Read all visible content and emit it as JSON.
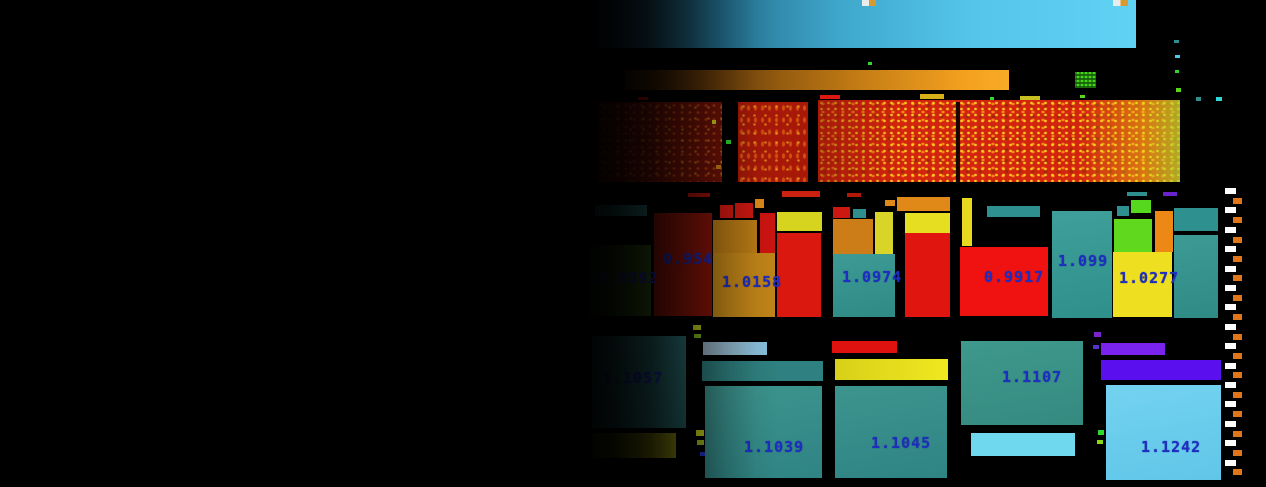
{
  "meta": {
    "width": 1266,
    "height": 487,
    "background": "#000000"
  },
  "colors": {
    "label_blue": "#1f2ec2",
    "legend_white": "#ffffff",
    "legend_orange": "#e0761a",
    "panel_blue_bright": "#60d2f4",
    "bar_orange_bright": "#f7ab26"
  },
  "chart_data": {
    "type": "heatmap",
    "title": "",
    "grid": false,
    "legend_position": "right",
    "series": [
      {
        "name": "middle-row-tiles",
        "points": [
          {
            "label": "0.9592",
            "value": 0.9592,
            "tile_color": "#3a6012"
          },
          {
            "label": "0.954",
            "value": 0.954,
            "tile_color": "#8c1408"
          },
          {
            "label": "1.0158",
            "value": 1.0158,
            "tile_color": "#c08418"
          },
          {
            "label": "1.0974",
            "value": 1.0974,
            "tile_color": "#2f9090"
          },
          {
            "label": "0.9917",
            "value": 0.9917,
            "tile_color": "#f01210"
          },
          {
            "label": "1.099",
            "value": 1.099,
            "tile_color": "#2f9595"
          },
          {
            "label": "1.0277",
            "value": 1.0277,
            "tile_color": "#eee020"
          }
        ]
      },
      {
        "name": "bottom-row-tiles",
        "points": [
          {
            "label": "1.1057",
            "value": 1.1057,
            "tile_color": "#2a6f70"
          },
          {
            "label": "1.1039",
            "value": 1.1039,
            "tile_color": "#2f8888"
          },
          {
            "label": "1.1045",
            "value": 1.1045,
            "tile_color": "#2f8888"
          },
          {
            "label": "1.1107",
            "value": 1.1107,
            "tile_color": "#35968c"
          },
          {
            "label": "1.1242",
            "value": 1.1242,
            "tile_color": "#66cbee"
          }
        ]
      }
    ]
  },
  "scene": {
    "blocks": [
      {
        "name": "top-blue-panel",
        "x": 598,
        "y": 0,
        "w": 538,
        "h": 48,
        "bg": "linear-gradient(90deg,#123140 0%,#24708f 22%,#3fa7cc 45%,#55c6ea 70%,#60d2f4 100%)"
      },
      {
        "name": "top-marker-icon-1",
        "x": 862,
        "y": 0,
        "w": 14,
        "h": 6,
        "inter": false,
        "bg": "linear-gradient(90deg,#e8ecec 0 50%,#d89a30 50% 100%)"
      },
      {
        "name": "top-marker-icon-2",
        "x": 1113,
        "y": 0,
        "w": 15,
        "h": 6,
        "inter": false,
        "bg": "linear-gradient(90deg,#e8ecec 0 50%,#d89a30 50% 100%)"
      },
      {
        "name": "orange-gradient-bar",
        "x": 625,
        "y": 70,
        "w": 384,
        "h": 20,
        "bg": "linear-gradient(90deg,#2e1603,#7c4a0c 30%,#c27b14 60%,#f3a01f 88%,#f7ab26)"
      },
      {
        "name": "green-texture-chip",
        "x": 1075,
        "y": 72,
        "w": 21,
        "h": 16,
        "cls": "chip"
      },
      {
        "name": "band-module-left",
        "x": 598,
        "y": 102,
        "w": 124,
        "h": 80,
        "cls": "speckle-dim"
      },
      {
        "name": "band-module-mid",
        "x": 738,
        "y": 102,
        "w": 70,
        "h": 80,
        "cls": "speckle-mid"
      },
      {
        "name": "band-module-right",
        "x": 818,
        "y": 100,
        "w": 362,
        "h": 82,
        "cls": "speckle-hot"
      },
      {
        "name": "band-divider",
        "x": 956,
        "y": 102,
        "w": 4,
        "h": 80,
        "inter": false,
        "bg": "#1a0500"
      },
      {
        "name": "mid-teal-strip",
        "x": 595,
        "y": 205,
        "w": 52,
        "h": 11,
        "bg": "#2f8585"
      },
      {
        "name": "mid-cell-0-9592",
        "x": 590,
        "y": 245,
        "w": 61,
        "h": 71,
        "bg": "linear-gradient(90deg,#1e3c12,#3a6012)",
        "label": "0.9592",
        "lx": 598,
        "ly": 269
      },
      {
        "name": "mid-cell-0-954",
        "x": 654,
        "y": 213,
        "w": 58,
        "h": 103,
        "bg": "#8c1408",
        "label": "0.954",
        "lx": 663,
        "ly": 250
      },
      {
        "name": "mid-red-chip-1",
        "x": 720,
        "y": 205,
        "w": 13,
        "h": 13,
        "bg": "#cc1810"
      },
      {
        "name": "mid-red-chip-2",
        "x": 735,
        "y": 203,
        "w": 18,
        "h": 15,
        "bg": "#cc1810"
      },
      {
        "name": "mid-tan-top",
        "x": 713,
        "y": 220,
        "w": 44,
        "h": 33,
        "bg": "#b87a16"
      },
      {
        "name": "mid-red-narrow",
        "x": 760,
        "y": 213,
        "w": 15,
        "h": 40,
        "bg": "#cc1410"
      },
      {
        "name": "mid-cell-1-0158",
        "x": 713,
        "y": 253,
        "w": 62,
        "h": 64,
        "bg": "#c08418",
        "label": "1.0158",
        "lx": 722,
        "ly": 273
      },
      {
        "name": "mid-yellow-top",
        "x": 777,
        "y": 212,
        "w": 45,
        "h": 19,
        "bg": "#d6d41e"
      },
      {
        "name": "mid-red-tall-1",
        "x": 777,
        "y": 233,
        "w": 44,
        "h": 84,
        "bg": "#da1810"
      },
      {
        "name": "mid-red-chip-3",
        "x": 833,
        "y": 207,
        "w": 17,
        "h": 11,
        "bg": "#cc1810"
      },
      {
        "name": "mid-teal-chip-1",
        "x": 853,
        "y": 209,
        "w": 13,
        "h": 9,
        "bg": "#2f8f8f"
      },
      {
        "name": "mid-orange-1",
        "x": 833,
        "y": 219,
        "w": 40,
        "h": 35,
        "bg": "#cc7d18"
      },
      {
        "name": "mid-yellow-narrow",
        "x": 875,
        "y": 212,
        "w": 18,
        "h": 42,
        "bg": "#d8d428"
      },
      {
        "name": "mid-cell-1-0974",
        "x": 833,
        "y": 254,
        "w": 62,
        "h": 63,
        "bg": "linear-gradient(170deg,#3d9a94,#2f8a85)",
        "label": "1.0974",
        "lx": 842,
        "ly": 268
      },
      {
        "name": "mid-orange-top-2",
        "x": 897,
        "y": 197,
        "w": 53,
        "h": 14,
        "bg": "#e08818"
      },
      {
        "name": "mid-yellow-2",
        "x": 905,
        "y": 213,
        "w": 45,
        "h": 20,
        "bg": "#e6de20"
      },
      {
        "name": "mid-red-tall-2",
        "x": 905,
        "y": 233,
        "w": 45,
        "h": 84,
        "bg": "#e01510"
      },
      {
        "name": "mid-yellow-vert",
        "x": 962,
        "y": 198,
        "w": 10,
        "h": 48,
        "bg": "#e8d820"
      },
      {
        "name": "mid-teal-hbar",
        "x": 987,
        "y": 206,
        "w": 53,
        "h": 11,
        "bg": "#2f9090"
      },
      {
        "name": "mid-cell-0-9917",
        "x": 960,
        "y": 247,
        "w": 88,
        "h": 69,
        "bg": "#f01210",
        "label": "0.9917",
        "lx": 984,
        "ly": 268
      },
      {
        "name": "mid-cell-1-099",
        "x": 1052,
        "y": 211,
        "w": 60,
        "h": 107,
        "bg": "linear-gradient(170deg,#3f9f9a,#2f8f8a)",
        "label": "1.099",
        "lx": 1058,
        "ly": 252
      },
      {
        "name": "mid-teal-chip-2",
        "x": 1117,
        "y": 206,
        "w": 12,
        "h": 10,
        "bg": "#2f9090"
      },
      {
        "name": "mid-green-chip-sm",
        "x": 1131,
        "y": 200,
        "w": 20,
        "h": 13,
        "bg": "#55d81e"
      },
      {
        "name": "mid-green-block",
        "x": 1114,
        "y": 219,
        "w": 38,
        "h": 33,
        "bg": "#5fd81e"
      },
      {
        "name": "mid-orange-vert",
        "x": 1155,
        "y": 211,
        "w": 18,
        "h": 41,
        "bg": "#ee8814"
      },
      {
        "name": "mid-cell-1-0277",
        "x": 1113,
        "y": 252,
        "w": 59,
        "h": 65,
        "bg": "#eee020",
        "label": "1.0277",
        "lx": 1119,
        "ly": 269
      },
      {
        "name": "mid-teal-right-top",
        "x": 1174,
        "y": 208,
        "w": 44,
        "h": 23,
        "bg": "#2f9090"
      },
      {
        "name": "mid-teal-right-main",
        "x": 1174,
        "y": 235,
        "w": 44,
        "h": 83,
        "bg": "linear-gradient(170deg,#3d9a94,#2f8a85)"
      },
      {
        "name": "bot-cell-1-1057",
        "x": 592,
        "y": 336,
        "w": 94,
        "h": 92,
        "bg": "linear-gradient(170deg,#2f7a7c,#266568)",
        "label": "1.1057",
        "lx": 603,
        "ly": 369
      },
      {
        "name": "bot-olive-bar",
        "x": 592,
        "y": 433,
        "w": 84,
        "h": 25,
        "bg": "linear-gradient(90deg,#3d3d04,#8a8a10)"
      },
      {
        "name": "bot-lightblue-bar-1",
        "x": 703,
        "y": 342,
        "w": 64,
        "h": 13,
        "bg": "linear-gradient(90deg,#9db6c8,#86c0dc)"
      },
      {
        "name": "bot-teal-hbar",
        "x": 702,
        "y": 361,
        "w": 121,
        "h": 20,
        "bg": "#2f8080"
      },
      {
        "name": "bot-cell-1-1039",
        "x": 705,
        "y": 386,
        "w": 117,
        "h": 92,
        "bg": "linear-gradient(170deg,#3d948e,#2f8484)",
        "label": "1.1039",
        "lx": 744,
        "ly": 438
      },
      {
        "name": "bot-red-bar",
        "x": 832,
        "y": 341,
        "w": 65,
        "h": 12,
        "bg": "#e01210"
      },
      {
        "name": "bot-yellow-bar",
        "x": 835,
        "y": 359,
        "w": 113,
        "h": 21,
        "bg": "linear-gradient(90deg,#d8d018,#f0e820)"
      },
      {
        "name": "bot-cell-1-1045",
        "x": 835,
        "y": 386,
        "w": 112,
        "h": 92,
        "bg": "linear-gradient(170deg,#3d948e,#2f8484)",
        "label": "1.1045",
        "lx": 871,
        "ly": 434
      },
      {
        "name": "bot-cell-1-1107",
        "x": 961,
        "y": 341,
        "w": 122,
        "h": 84,
        "bg": "linear-gradient(170deg,#3f988c,#358a80)",
        "label": "1.1107",
        "lx": 1002,
        "ly": 368
      },
      {
        "name": "bot-lightblue-bar-2",
        "x": 971,
        "y": 433,
        "w": 104,
        "h": 23,
        "bg": "#70d8ee"
      },
      {
        "name": "bot-purple-bar-1",
        "x": 1101,
        "y": 343,
        "w": 64,
        "h": 12,
        "bg": "#7a22ee"
      },
      {
        "name": "bot-purple-bar-2",
        "x": 1101,
        "y": 360,
        "w": 120,
        "h": 20,
        "bg": "#5a10ee"
      },
      {
        "name": "bot-cell-1-1242",
        "x": 1106,
        "y": 385,
        "w": 115,
        "h": 95,
        "bg": "linear-gradient(170deg,#74d2f0,#60c6e8)",
        "label": "1.1242",
        "lx": 1141,
        "ly": 438
      }
    ],
    "specks": [
      [
        638,
        97,
        10,
        3,
        "#cc1010"
      ],
      [
        820,
        95,
        20,
        4,
        "#dd1810"
      ],
      [
        920,
        94,
        24,
        5,
        "#d8b018"
      ],
      [
        1020,
        96,
        20,
        4,
        "#c8c020"
      ],
      [
        868,
        62,
        4,
        3,
        "#2fd82f"
      ],
      [
        990,
        97,
        4,
        3,
        "#2fd82f"
      ],
      [
        1080,
        95,
        5,
        3,
        "#58d818"
      ],
      [
        1196,
        97,
        5,
        4,
        "#2f8f8f"
      ],
      [
        1216,
        97,
        6,
        4,
        "#2fd8d8"
      ],
      [
        1174,
        40,
        5,
        3,
        "#2f8f8f"
      ],
      [
        1175,
        55,
        5,
        3,
        "#4fc8e8"
      ],
      [
        1175,
        70,
        4,
        3,
        "#2fd82f"
      ],
      [
        1176,
        88,
        5,
        4,
        "#58d818"
      ],
      [
        688,
        193,
        22,
        4,
        "#a01008"
      ],
      [
        782,
        191,
        38,
        6,
        "#cc2010"
      ],
      [
        847,
        193,
        14,
        4,
        "#b01808"
      ],
      [
        1127,
        192,
        20,
        4,
        "#2f8f8f"
      ],
      [
        1163,
        192,
        14,
        4,
        "#6a22cc"
      ],
      [
        755,
        199,
        9,
        9,
        "#dd8818"
      ],
      [
        885,
        200,
        10,
        6,
        "#e08818"
      ],
      [
        726,
        140,
        5,
        4,
        "#2fd82f"
      ],
      [
        712,
        120,
        4,
        4,
        "#d8d818"
      ],
      [
        716,
        165,
        5,
        4,
        "#cc8810"
      ],
      [
        693,
        325,
        8,
        5,
        "#c8d818"
      ],
      [
        694,
        334,
        7,
        4,
        "#88c818"
      ],
      [
        696,
        430,
        8,
        6,
        "#c8d818"
      ],
      [
        697,
        440,
        7,
        5,
        "#a8c020"
      ],
      [
        700,
        452,
        5,
        4,
        "#2233cc"
      ],
      [
        1094,
        332,
        7,
        5,
        "#7a22cc"
      ],
      [
        1093,
        345,
        6,
        4,
        "#5533cc"
      ],
      [
        1098,
        430,
        6,
        5,
        "#2fd82f"
      ],
      [
        1097,
        440,
        6,
        4,
        "#88d818"
      ]
    ],
    "legend_strip": {
      "count": 30,
      "y_start": 188,
      "step": 9.7,
      "dash_h": 6,
      "x_white": 1225,
      "w_white": 11,
      "x_orange": 1233,
      "w_orange": 9,
      "color_white": "#ffffff",
      "color_orange": "#e0761a"
    }
  }
}
